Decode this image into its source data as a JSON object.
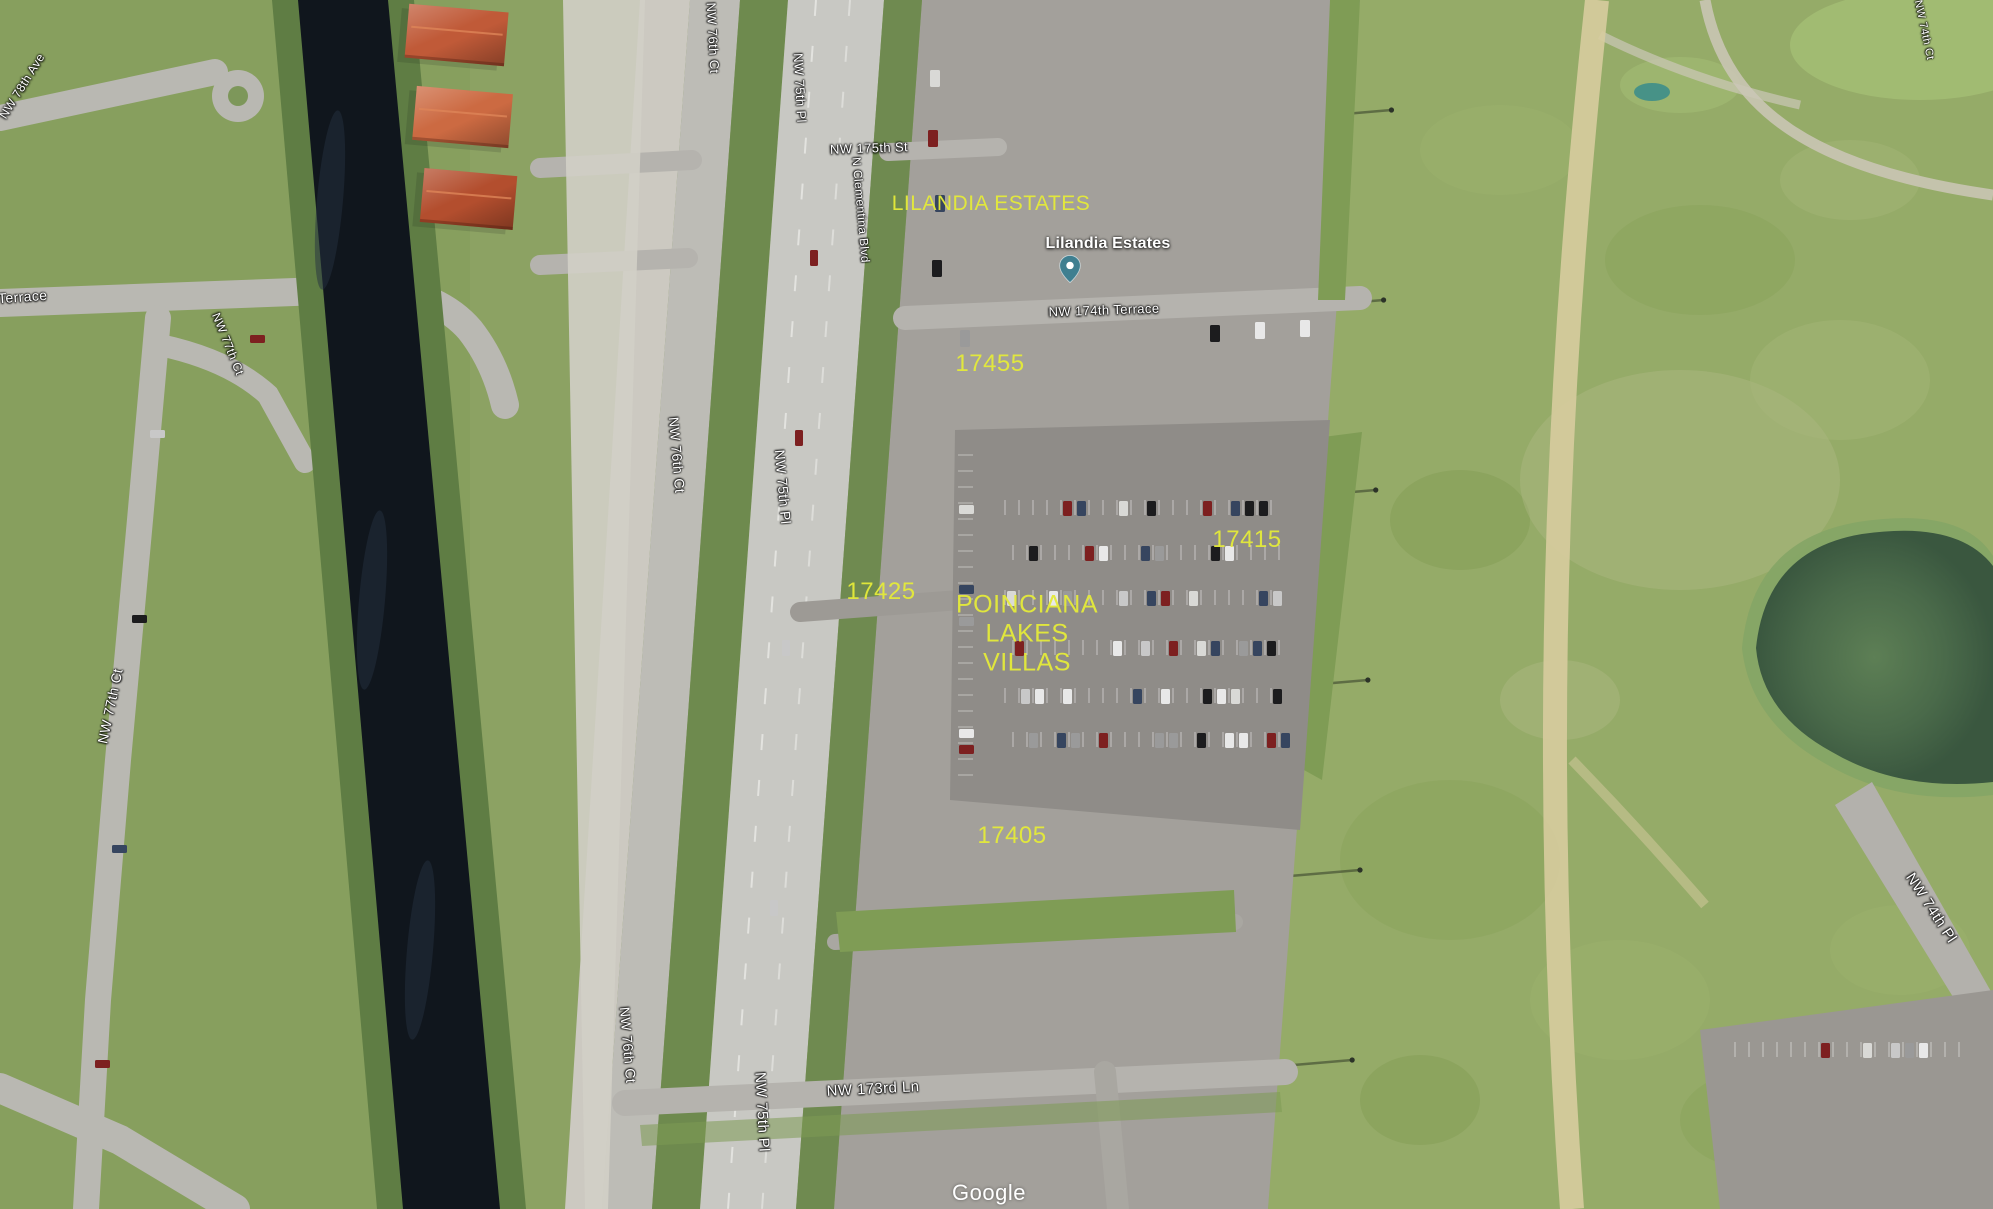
{
  "map": {
    "street_labels": [
      {
        "id": "nw-78th-ave",
        "text": "NW 78th Ave"
      },
      {
        "id": "nw-174th-terrace-west",
        "text": "NW 174th Terrace"
      },
      {
        "id": "nw-77th-ct-upper",
        "text": "NW 77th Ct"
      },
      {
        "id": "nw-77th-ct",
        "text": "NW 77th Ct"
      },
      {
        "id": "nw-76th-ct-top",
        "text": "NW 76th Ct"
      },
      {
        "id": "nw-75th-pl-top",
        "text": "NW 75th Pl"
      },
      {
        "id": "nw-175th-st",
        "text": "NW 175th St"
      },
      {
        "id": "n-clementina-blvd",
        "text": "N Clementina Blvd"
      },
      {
        "id": "nw-174th-terrace",
        "text": "NW 174th Terrace"
      },
      {
        "id": "nw-76th-ct-mid",
        "text": "NW 76th Ct"
      },
      {
        "id": "nw-75th-pl-mid",
        "text": "NW 75th Pl"
      },
      {
        "id": "nw-76th-ct-bottom",
        "text": "NW 76th Ct"
      },
      {
        "id": "nw-75th-pl-bottom",
        "text": "NW 75th Pl"
      },
      {
        "id": "nw-173rd-ln",
        "text": "NW 173rd Ln"
      },
      {
        "id": "nw-74th-pl",
        "text": "NW 74th Pl"
      },
      {
        "id": "nw-74th-ct-top",
        "text": "NW 74th Ct"
      }
    ],
    "annotations": {
      "color": "#e4ea3a",
      "items": [
        {
          "id": "lilandia-estates-annotation",
          "text": "LILANDIA ESTATES"
        },
        {
          "id": "parcel-17455",
          "text": "17455"
        },
        {
          "id": "parcel-17415",
          "text": "17415"
        },
        {
          "id": "parcel-17425",
          "text": "17425"
        },
        {
          "id": "poinciana-lakes-villas",
          "lines": [
            "POINCIANA",
            "LAKES",
            "VILLAS"
          ]
        },
        {
          "id": "parcel-17405",
          "text": "17405"
        }
      ]
    },
    "place_marker": {
      "label": "Lilandia Estates",
      "pin_color": "#3f7f90"
    },
    "watermark": "Google"
  }
}
